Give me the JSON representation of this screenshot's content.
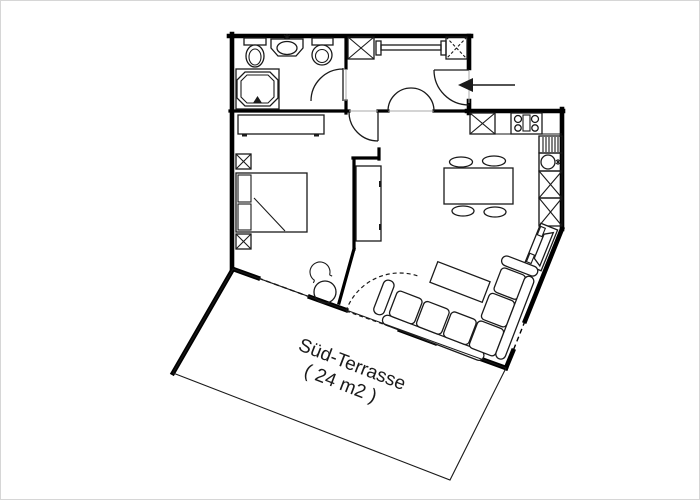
{
  "colors": {
    "background": "#ffffff",
    "ink": "#1a1a1a",
    "wall": "#000000",
    "frame": "#d6d6d6",
    "thin": "#aaaaaa"
  },
  "terrace": {
    "label": "Süd-Terrasse",
    "area": "( 24 m2 )"
  },
  "entrance": {
    "arrow_direction": "left"
  },
  "icons": [
    "toilet-icon",
    "washbasin-icon",
    "toilet-icon",
    "shower-icon",
    "closet-icon",
    "clothes-rail-icon",
    "closet-icon",
    "wardrobe-icon",
    "nightstand-icon",
    "bed-icon",
    "nightstand-icon",
    "chair-icon",
    "round-table-icon",
    "cabinet-icon",
    "kitchen-cabinet-icon",
    "stove-icon",
    "drawer-unit-icon",
    "sink-icon",
    "dining-table-icon",
    "dining-chair-icon",
    "tv-cabinet-icon",
    "coffee-table-icon",
    "sofa-icon"
  ]
}
